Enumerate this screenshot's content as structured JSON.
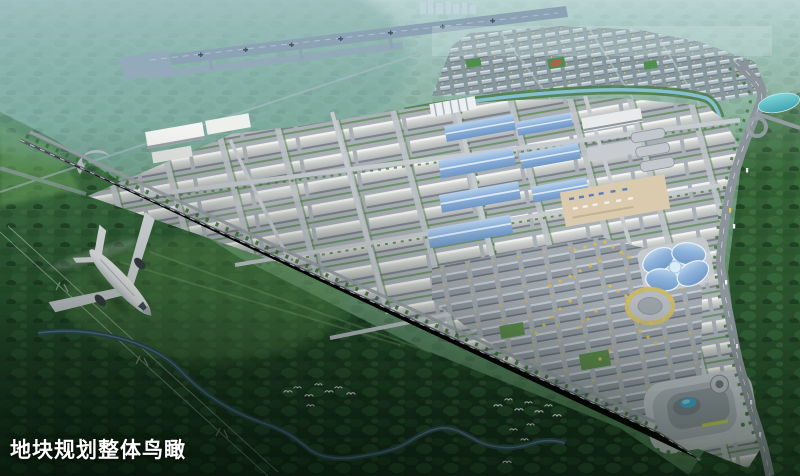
{
  "caption": {
    "text": "地块规划整体鸟瞰"
  },
  "scene": {
    "type": "aerial-masterplan-rendering",
    "landmarks": [
      "airport-runway",
      "distant-city-skyline",
      "residential-district",
      "canal",
      "industrial-park",
      "blue-roof-warehouses",
      "white-warehouses",
      "truck-yard",
      "commercial-district",
      "butterfly-glass-building",
      "circular-plaza",
      "mall-complex",
      "highway",
      "cyan-lake",
      "railway",
      "river",
      "power-lines",
      "airplane",
      "egret-birds",
      "forest"
    ],
    "palette": {
      "sky_haze": "#8fb3b8",
      "hill_teal": "#57958f",
      "forest_green": "#2e5c33",
      "forest_dark": "#16301c",
      "park_ground": "#aab2b8",
      "roof_light": "#dadbd8",
      "roof_blue": "#7fa9d6",
      "water_river": "#35566b",
      "lake_cyan": "#5fc8cf",
      "tree_yellow": "#dcba50",
      "road_gray": "#8b949b",
      "runway_gray": "#8ba3b5",
      "plane_white": "#f4f6f7"
    }
  }
}
